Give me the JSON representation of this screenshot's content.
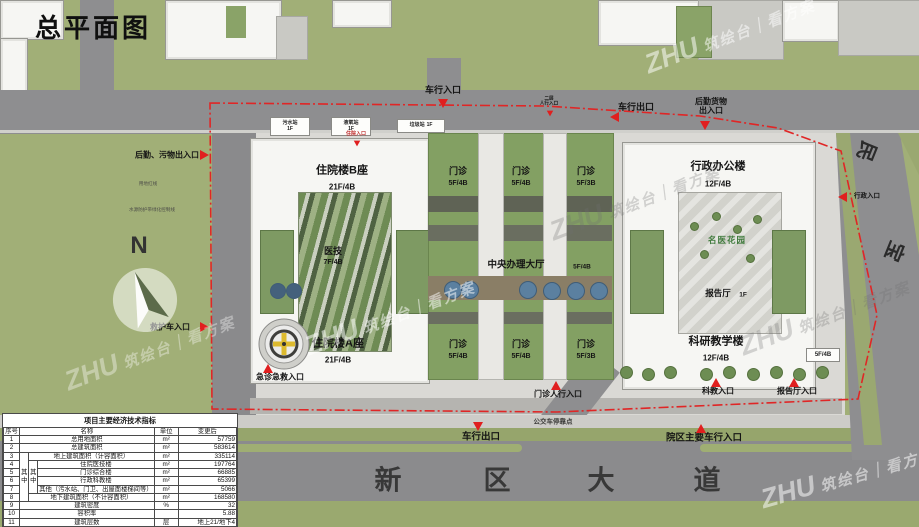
{
  "title": "总平面图",
  "watermark": {
    "brand": "ZHU",
    "text": "筑绘台｜看方案"
  },
  "compass": {
    "label": "N"
  },
  "site": {
    "notes": {
      "red_line": "用地红线",
      "buffer": "水源防护带绿化控制线"
    }
  },
  "buildings": {
    "inpatient_b": {
      "name": "住院楼B座",
      "floors": "21F/4B"
    },
    "inpatient_a": {
      "name": "住院楼A座",
      "floors": "21F/4B"
    },
    "medtech": {
      "name": "医技",
      "floors": "7F/4B"
    },
    "central_hall": {
      "name": "中央办理大厅",
      "floors": "5F/4B"
    },
    "admin": {
      "name": "行政办公楼",
      "floors": "12F/4B"
    },
    "research": {
      "name": "科研教学楼",
      "floors": "12F/4B"
    },
    "lecture_hall": {
      "name": "报告厅",
      "floors": "1F"
    },
    "garden": {
      "name": "名医花园"
    },
    "research_annex": {
      "floors": "5F/4B"
    },
    "outpatient_top": [
      {
        "name": "门诊",
        "floors": "5F/4B"
      },
      {
        "name": "门诊",
        "floors": "5F/4B"
      },
      {
        "name": "门诊",
        "floors": "5F/3B"
      }
    ],
    "outpatient_bottom": [
      {
        "name": "门诊",
        "floors": "5F/4B"
      },
      {
        "name": "门诊",
        "floors": "5F/4B"
      },
      {
        "name": "门诊",
        "floors": "5F/3B"
      }
    ]
  },
  "utilities": [
    {
      "name": "污水站",
      "floor": "1F"
    },
    {
      "name": "液氧站",
      "floor": "1F"
    },
    {
      "name": "垃圾站",
      "floor": "1F"
    }
  ],
  "entrances": {
    "vehicle_in_top": {
      "label": "车行入口"
    },
    "second_floor_ped": {
      "label": "二层\n人行入口"
    },
    "vehicle_out_top": {
      "label": "车行出口"
    },
    "logistics_goods": {
      "label": "后勤货物\n出入口"
    },
    "logistics_waste_west": {
      "label": "后勤、污物出入口"
    },
    "ambulance_west": {
      "label": "救护车入口"
    },
    "admin_east": {
      "label": "行政入口"
    },
    "inpatient_north": {
      "label": "住院入口"
    },
    "emergency_south": {
      "label": "急诊急救入口"
    },
    "outpatient_ped_south": {
      "label": "门诊人行入口"
    },
    "research_south": {
      "label": "科教入口"
    },
    "lecture_south": {
      "label": "报告厅入口"
    },
    "vehicle_out_south": {
      "label": "车行出口"
    },
    "main_vehicle_in_south": {
      "label": "院区主要车行入口"
    }
  },
  "roads": {
    "bottom_avenue_chars": [
      "新",
      "区",
      "大",
      "道"
    ],
    "right_road_chars": [
      "民",
      "宝"
    ],
    "bus_stop": "公交车停靠点"
  },
  "table": {
    "title": "项目主要经济技术指标",
    "header": [
      {
        "t": "序号"
      },
      {
        "t": "名称",
        "cs": 3
      },
      {
        "t": "单位"
      },
      {
        "t": "变更后"
      }
    ],
    "rows": [
      [
        {
          "t": "1"
        },
        {
          "t": "总用地面积",
          "cs": 3
        },
        {
          "t": "m²"
        },
        {
          "t": "57759",
          "al": "r"
        }
      ],
      [
        {
          "t": "2"
        },
        {
          "t": "总建筑面积",
          "cs": 3
        },
        {
          "t": "m²"
        },
        {
          "t": "583614",
          "al": "r"
        }
      ],
      [
        {
          "t": "3"
        },
        {
          "t": "其中",
          "rs": 6,
          "v": 1
        },
        {
          "t": "地上建筑面积（计容面积）",
          "cs": 2
        },
        {
          "t": "m²"
        },
        {
          "t": "335114",
          "al": "r"
        }
      ],
      [
        {
          "t": "4"
        },
        {
          "t": "其中",
          "rs": 4,
          "v": 1
        },
        {
          "t": "住院医技楼"
        },
        {
          "t": "m²"
        },
        {
          "t": "197764",
          "al": "r"
        }
      ],
      [
        {
          "t": "5"
        },
        {
          "t": "门诊综合楼"
        },
        {
          "t": "m²"
        },
        {
          "t": "66885",
          "al": "r"
        }
      ],
      [
        {
          "t": "6"
        },
        {
          "t": "行政科教楼"
        },
        {
          "t": "m²"
        },
        {
          "t": "65399",
          "al": "r"
        }
      ],
      [
        {
          "t": "7"
        },
        {
          "t": "其他（污水站、门卫、出屋面楼梯间等）"
        },
        {
          "t": "m²"
        },
        {
          "t": "5066",
          "al": "r"
        }
      ],
      [
        {
          "t": "8"
        },
        {
          "t": "地下建筑面积（不计容面积）",
          "cs": 2
        },
        {
          "t": "m²"
        },
        {
          "t": "168580",
          "al": "r"
        }
      ],
      [
        {
          "t": "9"
        },
        {
          "t": "建筑密度",
          "cs": 3
        },
        {
          "t": "%"
        },
        {
          "t": "32",
          "al": "r"
        }
      ],
      [
        {
          "t": "10"
        },
        {
          "t": "容积率",
          "cs": 3
        },
        {
          "t": ""
        },
        {
          "t": "5.88",
          "al": "r"
        }
      ],
      [
        {
          "t": "11"
        },
        {
          "t": "建筑层数",
          "cs": 3
        },
        {
          "t": "层"
        },
        {
          "t": "地上21/地下4",
          "al": "r"
        }
      ],
      [
        {
          "t": "12"
        },
        {
          "t": "建筑高度",
          "cs": 3
        },
        {
          "t": "米"
        },
        {
          "t": "86.25",
          "al": "r"
        }
      ],
      [
        {
          "t": "13"
        },
        {
          "t": "床位数",
          "cs": 3
        },
        {
          "t": "床"
        },
        {
          "t": "2500",
          "al": "r"
        }
      ],
      [
        {
          "t": "14"
        },
        {
          "t": "机动车停车位",
          "cs": 3
        },
        {
          "t": "辆"
        },
        {
          "t": "2880",
          "al": "r"
        }
      ]
    ]
  }
}
